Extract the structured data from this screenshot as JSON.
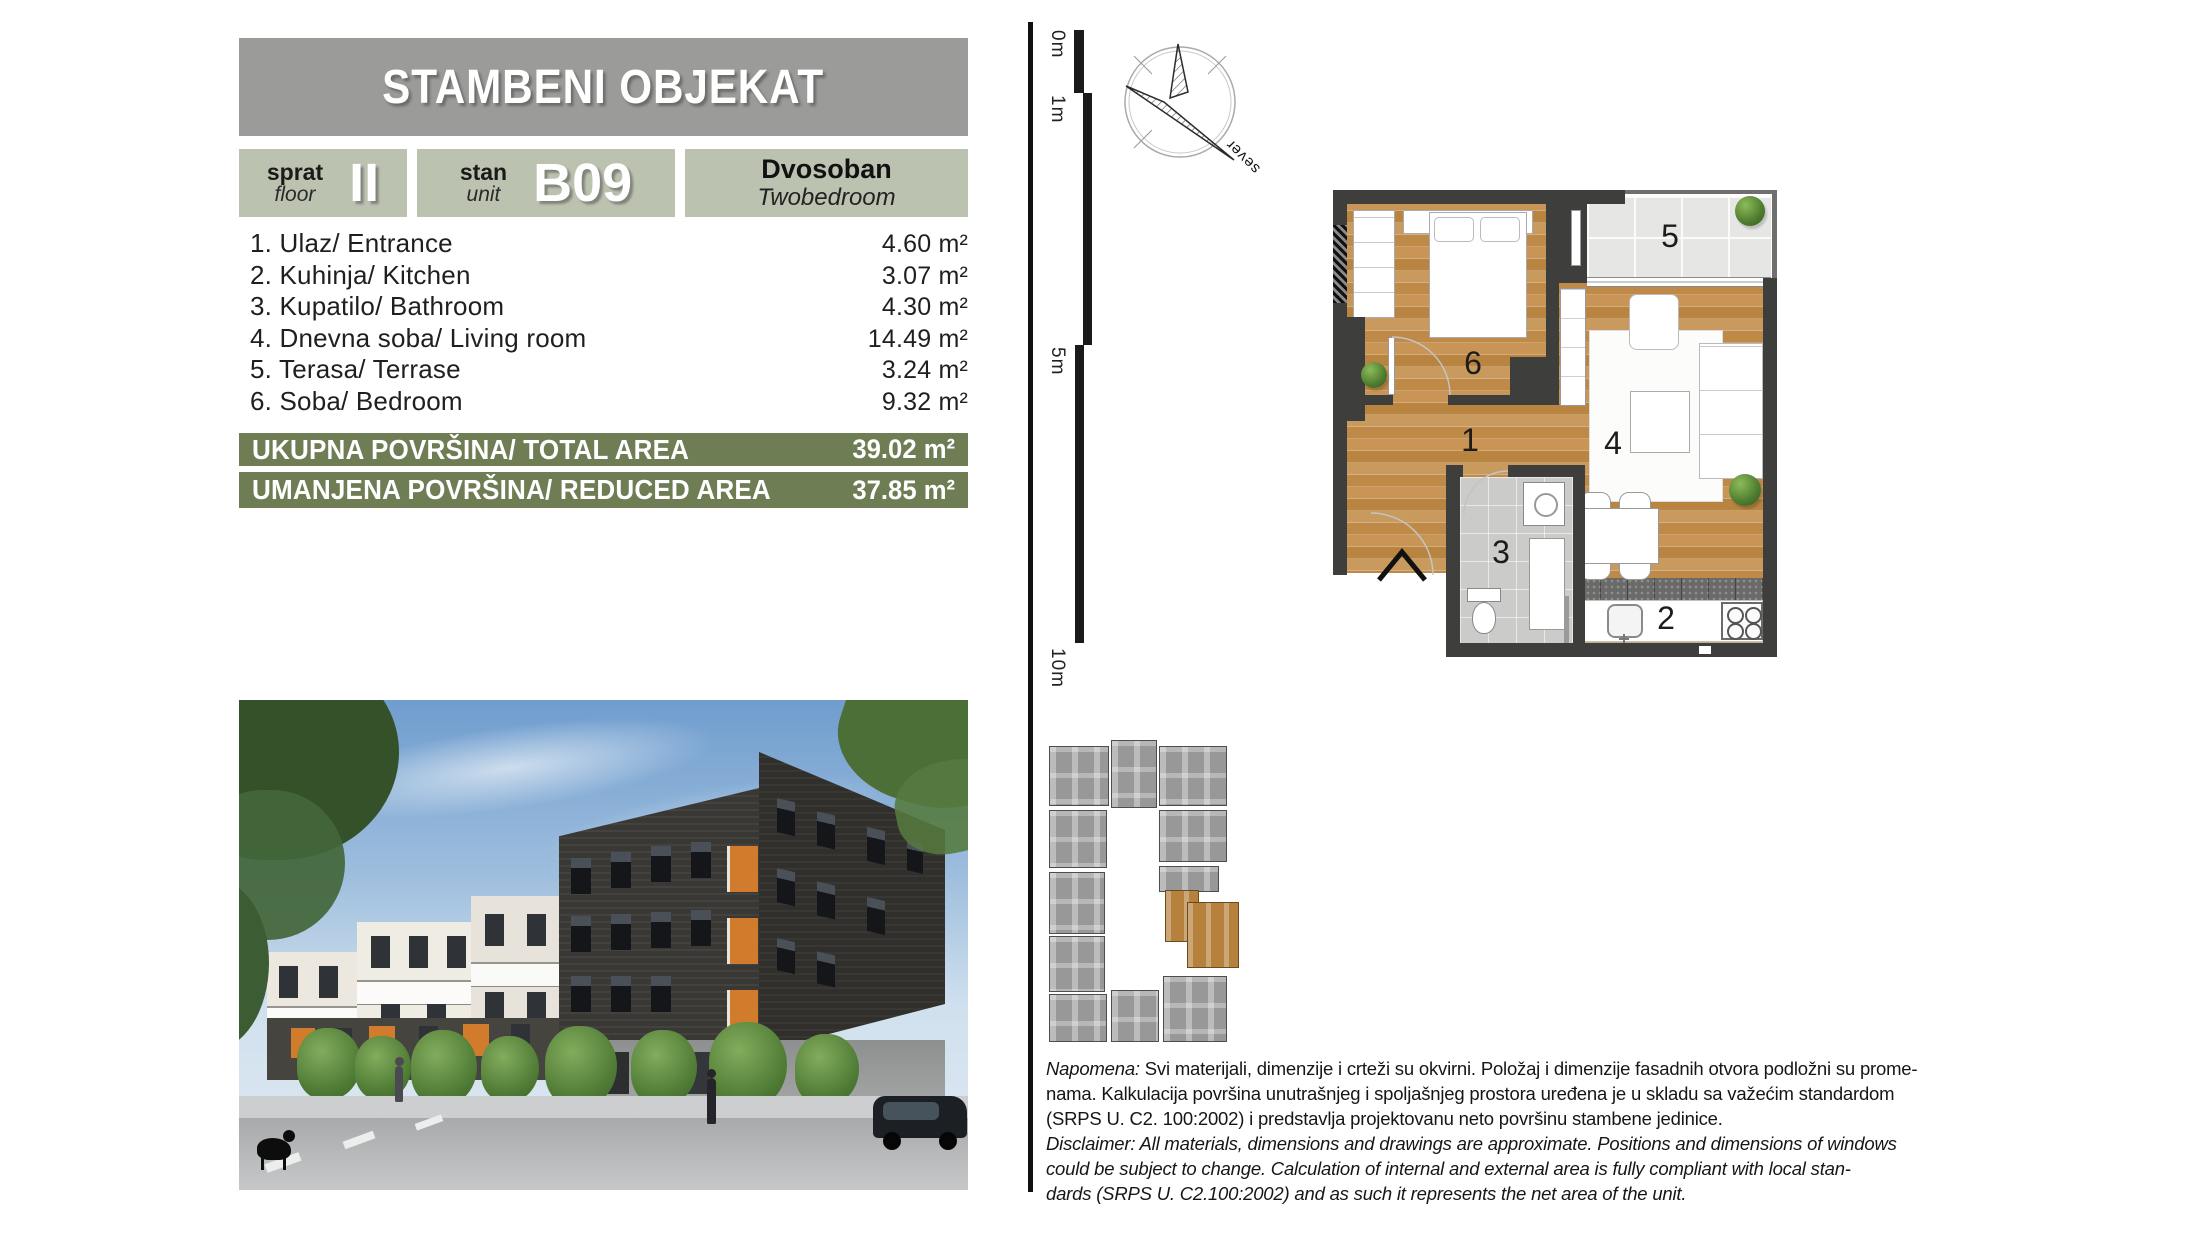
{
  "page": {
    "title": "STAMBENI OBJEKAT"
  },
  "unit_info": {
    "floor_label_sr": "sprat",
    "floor_label_en": "floor",
    "floor_value": "II",
    "unit_label_sr": "stan",
    "unit_label_en": "unit",
    "unit_value": "B09",
    "type_sr": "Dvosoban",
    "type_en": "Twobedroom"
  },
  "rooms": [
    {
      "name": "1. Ulaz/ Entrance",
      "area": "4.60 m²"
    },
    {
      "name": "2. Kuhinja/ Kitchen",
      "area": "3.07 m²"
    },
    {
      "name": "3. Kupatilo/ Bathroom",
      "area": "4.30 m²"
    },
    {
      "name": "4. Dnevna soba/ Living room",
      "area": "14.49 m²"
    },
    {
      "name": "5. Terasa/ Terrase",
      "area": "3.24 m²"
    },
    {
      "name": "6. Soba/ Bedroom",
      "area": "9.32 m²"
    }
  ],
  "totals": [
    {
      "label": "UKUPNA POVRŠINA/ TOTAL AREA",
      "value": "39.02 m²"
    },
    {
      "label": "UMANJENA POVRŠINA/ REDUCED AREA",
      "value": "37.85 m²"
    }
  ],
  "scale_ruler": {
    "labels": [
      "0m",
      "1m",
      "5m",
      "10m"
    ]
  },
  "compass": {
    "north_label": "sever"
  },
  "floor_plan": {
    "room_numbers": {
      "n1": "1",
      "n2": "2",
      "n3": "3",
      "n4": "4",
      "n5": "5",
      "n6": "6"
    }
  },
  "disclaimer": {
    "label_sr": "Napomena:",
    "lines_sr": [
      " Svi materijali, dimenzije i crteži su okvirni. Položaj i dimenzije fasadnih otvora podložni su prome-",
      "nama. Kalkulacija površina unutrašnjeg i spoljašnjeg prostora uređena je u skladu sa važećim standardom",
      "(SRPS U. C2. 100:2002) i predstavlja projektovanu neto površinu stambene jedinice."
    ],
    "lines_en": [
      "Disclaimer: All materials, dimensions and drawings are approximate. Positions and dimensions of windows",
      "could be subject to change. Calculation of internal and external area is fully compliant with local stan-",
      "dards (SRPS U. C2.100:2002) and as such it represents the net area of the unit."
    ]
  },
  "colors": {
    "header_gray": "#9b9b99",
    "box_sage": "#bcc2b0",
    "bar_olive": "#6e7d54",
    "wood": "#c28c49",
    "accent_orange": "#d17b2c",
    "highlight_unit_orange": "#b5813d"
  }
}
